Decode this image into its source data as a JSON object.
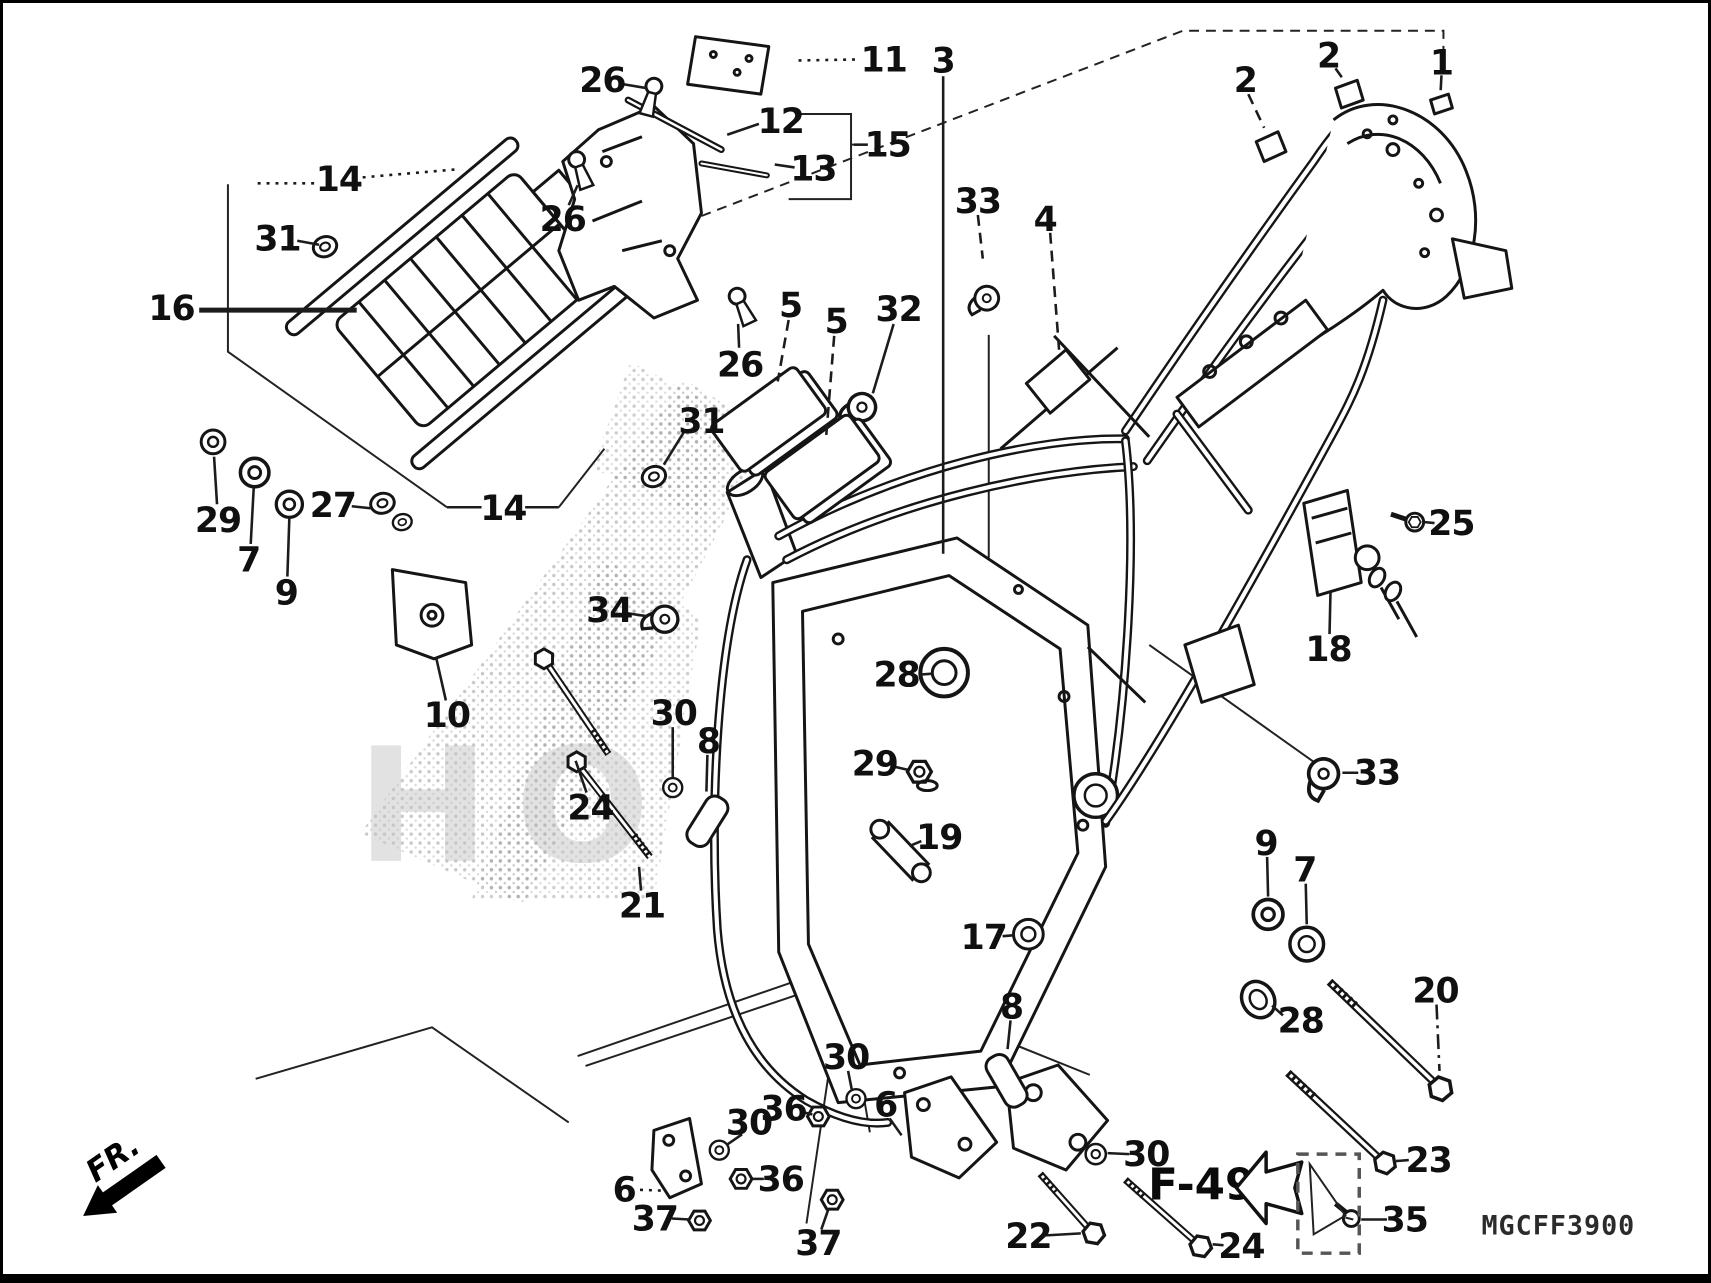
{
  "title": "frame exploded parts diagram",
  "footer": {
    "page_ref": "F-49",
    "part_code": "MGCFF3900",
    "front_label": "FR."
  },
  "watermark": {
    "text": "HO"
  },
  "callouts": [
    {
      "n": "26",
      "x": 600,
      "y": 78,
      "lead": [
        [
          621,
          82
        ],
        [
          645,
          86
        ]
      ],
      "style": "solid"
    },
    {
      "n": "11",
      "x": 884,
      "y": 57,
      "lead": [
        [
          798,
          58
        ],
        [
          858,
          57
        ]
      ],
      "style": "dot"
    },
    {
      "n": "12",
      "x": 780,
      "y": 119,
      "lead": [
        [
          726,
          133
        ],
        [
          758,
          122
        ]
      ],
      "style": "solid"
    },
    {
      "n": "13",
      "x": 813,
      "y": 167,
      "lead": [
        [
          774,
          163
        ],
        [
          794,
          166
        ]
      ],
      "style": "solid"
    },
    {
      "n": "15",
      "x": 888,
      "y": 143,
      "lead": [
        [
          868,
          143
        ],
        [
          854,
          143
        ]
      ],
      "style": "solid"
    },
    {
      "n": "2",
      "x": 1249,
      "y": 78,
      "lead": [
        [
          1252,
          92
        ],
        [
          1268,
          126
        ]
      ],
      "style": "dash"
    },
    {
      "n": "2",
      "x": 1333,
      "y": 53,
      "lead": [
        [
          1340,
          66
        ],
        [
          1350,
          80
        ]
      ],
      "style": "dash"
    },
    {
      "n": "1",
      "x": 1447,
      "y": 60,
      "lead": [
        [
          1447,
          73
        ],
        [
          1446,
          92
        ]
      ],
      "style": "dashdot"
    },
    {
      "n": "3",
      "x": 944,
      "y": 58,
      "lead": [
        [
          944,
          74
        ],
        [
          944,
          556
        ]
      ],
      "style": "solid"
    },
    {
      "n": "33",
      "x": 979,
      "y": 200,
      "lead": [
        [
          979,
          214
        ],
        [
          984,
          258
        ]
      ],
      "style": "dash"
    },
    {
      "n": "4",
      "x": 1047,
      "y": 218,
      "lead": [
        [
          1052,
          232
        ],
        [
          1061,
          350
        ]
      ],
      "style": "dash"
    },
    {
      "n": "14",
      "x": 334,
      "y": 178,
      "lead": [
        [
          252,
          182
        ],
        [
          310,
          182
        ]
      ],
      "lead2": [
        [
          358,
          176
        ],
        [
          452,
          168
        ]
      ],
      "style": "dot"
    },
    {
      "n": "31",
      "x": 272,
      "y": 238,
      "lead": [
        [
          292,
          240
        ],
        [
          314,
          244
        ]
      ],
      "style": "solid"
    },
    {
      "n": "16",
      "x": 165,
      "y": 308,
      "lead": [
        [
          193,
          310
        ],
        [
          352,
          310
        ]
      ],
      "style": "solid",
      "w": 5
    },
    {
      "n": "26",
      "x": 560,
      "y": 218,
      "lead": [
        [
          566,
          204
        ],
        [
          575,
          184
        ]
      ],
      "style": "solid"
    },
    {
      "n": "26",
      "x": 739,
      "y": 365,
      "lead": [
        [
          738,
          348
        ],
        [
          737,
          324
        ]
      ],
      "style": "solid"
    },
    {
      "n": "5",
      "x": 790,
      "y": 305,
      "lead": [
        [
          788,
          320
        ],
        [
          777,
          382
        ]
      ],
      "style": "dash"
    },
    {
      "n": "5",
      "x": 836,
      "y": 321,
      "lead": [
        [
          834,
          336
        ],
        [
          826,
          436
        ]
      ],
      "style": "dash"
    },
    {
      "n": "32",
      "x": 899,
      "y": 309,
      "lead": [
        [
          894,
          324
        ],
        [
          873,
          394
        ]
      ],
      "style": "solid"
    },
    {
      "n": "31",
      "x": 700,
      "y": 422,
      "lead": [
        [
          683,
          432
        ],
        [
          662,
          466
        ]
      ],
      "style": "solid"
    },
    {
      "n": "29",
      "x": 212,
      "y": 522,
      "lead": [
        [
          211,
          506
        ],
        [
          208,
          458
        ]
      ],
      "style": "solid"
    },
    {
      "n": "7",
      "x": 243,
      "y": 562,
      "lead": [
        [
          245,
          546
        ],
        [
          248,
          490
        ]
      ],
      "style": "solid"
    },
    {
      "n": "9",
      "x": 281,
      "y": 595,
      "lead": [
        [
          282,
          579
        ],
        [
          284,
          520
        ]
      ],
      "style": "solid"
    },
    {
      "n": "27",
      "x": 328,
      "y": 507,
      "lead": [
        [
          347,
          508
        ],
        [
          366,
          510
        ]
      ],
      "style": "solid"
    },
    {
      "n": "14",
      "x": 500,
      "y": 510,
      "lead": [
        [
          443,
          509
        ],
        [
          478,
          509
        ]
      ],
      "lead2": [
        [
          522,
          509
        ],
        [
          556,
          509
        ]
      ],
      "style": "solid"
    },
    {
      "n": "34",
      "x": 607,
      "y": 613,
      "lead": [
        [
          625,
          616
        ],
        [
          645,
          619
        ]
      ],
      "style": "solid"
    },
    {
      "n": "10",
      "x": 443,
      "y": 719,
      "lead": [
        [
          442,
          704
        ],
        [
          432,
          660
        ]
      ],
      "style": "solid"
    },
    {
      "n": "24",
      "x": 588,
      "y": 812,
      "lead": [
        [
          584,
          797
        ],
        [
          573,
          765
        ]
      ],
      "style": "solid"
    },
    {
      "n": "30",
      "x": 672,
      "y": 717,
      "lead": [
        [
          671,
          731
        ],
        [
          671,
          782
        ]
      ],
      "style": "solid"
    },
    {
      "n": "8",
      "x": 707,
      "y": 745,
      "lead": [
        [
          706,
          759
        ],
        [
          705,
          796
        ]
      ],
      "style": "solid"
    },
    {
      "n": "21",
      "x": 640,
      "y": 911,
      "lead": [
        [
          639,
          896
        ],
        [
          637,
          872
        ]
      ],
      "style": "solid"
    },
    {
      "n": "28",
      "x": 897,
      "y": 678,
      "lead": [
        [
          919,
          678
        ],
        [
          933,
          677
        ]
      ],
      "style": "solid"
    },
    {
      "n": "29",
      "x": 875,
      "y": 768,
      "lead": [
        [
          895,
          771
        ],
        [
          908,
          774
        ]
      ],
      "style": "solid"
    },
    {
      "n": "19",
      "x": 940,
      "y": 842,
      "lead": [
        [
          922,
          846
        ],
        [
          910,
          851
        ]
      ],
      "style": "solid"
    },
    {
      "n": "17",
      "x": 985,
      "y": 943,
      "lead": [
        [
          1004,
          942
        ],
        [
          1016,
          941
        ]
      ],
      "style": "solid"
    },
    {
      "n": "25",
      "x": 1457,
      "y": 525,
      "lead": [
        [
          1440,
          525
        ],
        [
          1430,
          524
        ]
      ],
      "style": "solid"
    },
    {
      "n": "18",
      "x": 1333,
      "y": 652,
      "lead": [
        [
          1334,
          637
        ],
        [
          1335,
          594
        ]
      ],
      "style": "solid"
    },
    {
      "n": "33",
      "x": 1382,
      "y": 777,
      "lead": [
        [
          1363,
          777
        ],
        [
          1347,
          777
        ]
      ],
      "style": "solid"
    },
    {
      "n": "9",
      "x": 1270,
      "y": 848,
      "lead": [
        [
          1271,
          862
        ],
        [
          1272,
          902
        ]
      ],
      "style": "solid"
    },
    {
      "n": "7",
      "x": 1309,
      "y": 875,
      "lead": [
        [
          1310,
          889
        ],
        [
          1311,
          930
        ]
      ],
      "style": "solid"
    },
    {
      "n": "28",
      "x": 1305,
      "y": 1027,
      "lead": [
        [
          1287,
          1022
        ],
        [
          1276,
          1012
        ]
      ],
      "style": "solid"
    },
    {
      "n": "20",
      "x": 1441,
      "y": 997,
      "lead": [
        [
          1442,
          1011
        ],
        [
          1445,
          1078
        ]
      ],
      "style": "dashdot"
    },
    {
      "n": "23",
      "x": 1434,
      "y": 1168,
      "lead": [
        [
          1414,
          1168
        ],
        [
          1401,
          1169
        ]
      ],
      "style": "solid"
    },
    {
      "n": "35",
      "x": 1410,
      "y": 1228,
      "lead": [
        [
          1392,
          1228
        ],
        [
          1366,
          1228
        ]
      ],
      "style": "solid"
    },
    {
      "n": "24",
      "x": 1245,
      "y": 1255,
      "lead": [
        [
          1227,
          1254
        ],
        [
          1216,
          1253
        ]
      ],
      "style": "solid"
    },
    {
      "n": "22",
      "x": 1030,
      "y": 1245,
      "lead": [
        [
          1048,
          1244
        ],
        [
          1083,
          1242
        ]
      ],
      "style": "solid"
    },
    {
      "n": "30",
      "x": 1149,
      "y": 1162,
      "lead": [
        [
          1132,
          1162
        ],
        [
          1110,
          1161
        ]
      ],
      "style": "solid"
    },
    {
      "n": "30",
      "x": 846,
      "y": 1064,
      "lead": [
        [
          848,
          1078
        ],
        [
          852,
          1098
        ]
      ],
      "style": "solid"
    },
    {
      "n": "36",
      "x": 783,
      "y": 1116,
      "lead": [
        [
          800,
          1119
        ],
        [
          812,
          1122
        ]
      ],
      "style": "solid"
    },
    {
      "n": "6",
      "x": 886,
      "y": 1112,
      "lead": [
        [
          890,
          1126
        ],
        [
          902,
          1143
        ]
      ],
      "style": "solid"
    },
    {
      "n": "30",
      "x": 748,
      "y": 1130,
      "lead": [
        [
          741,
          1142
        ],
        [
          725,
          1153
        ]
      ],
      "style": "solid"
    },
    {
      "n": "36",
      "x": 780,
      "y": 1187,
      "lead": [
        [
          763,
          1187
        ],
        [
          752,
          1187
        ]
      ],
      "style": "solid"
    },
    {
      "n": "6",
      "x": 622,
      "y": 1198,
      "lead": [
        [
          638,
          1198
        ],
        [
          664,
          1199
        ]
      ],
      "style": "dot"
    },
    {
      "n": "37",
      "x": 653,
      "y": 1227,
      "lead": [
        [
          670,
          1227
        ],
        [
          688,
          1228
        ]
      ],
      "style": "solid"
    },
    {
      "n": "37",
      "x": 818,
      "y": 1252,
      "lead": [
        [
          821,
          1238
        ],
        [
          828,
          1218
        ]
      ],
      "style": "solid"
    },
    {
      "n": "8",
      "x": 1013,
      "y": 1013,
      "lead": [
        [
          1012,
          1027
        ],
        [
          1009,
          1056
        ]
      ],
      "style": "solid"
    }
  ]
}
